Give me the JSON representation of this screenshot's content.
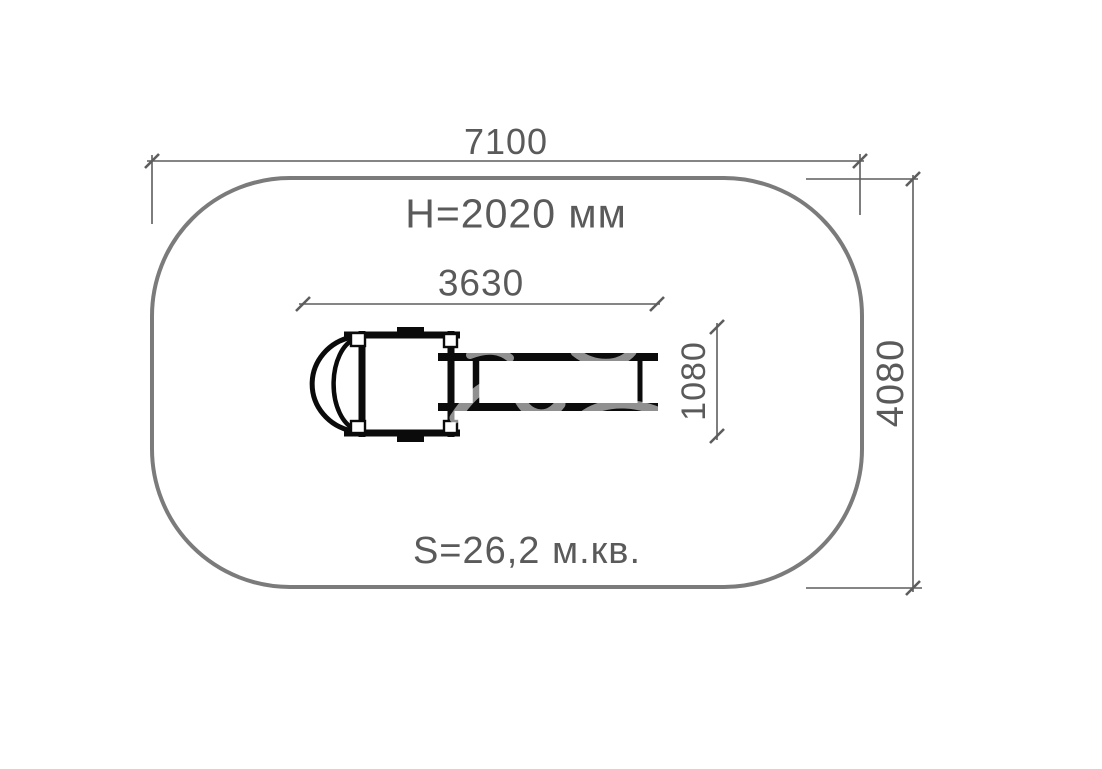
{
  "diagram": {
    "labels": {
      "overall_width": "7100",
      "equipment_height": "H=2020 мм",
      "equipment_length": "3630",
      "equipment_width": "1080",
      "overall_depth": "4080",
      "safety_area": "S=26,2 м.кв."
    },
    "colors": {
      "background": "#ffffff",
      "safety_zone_outline": "#7b7b7b",
      "dimension_lines": "#5d5d5d",
      "label_text": "#5a5a5a",
      "equipment_outline": "#0b0b0b"
    }
  }
}
